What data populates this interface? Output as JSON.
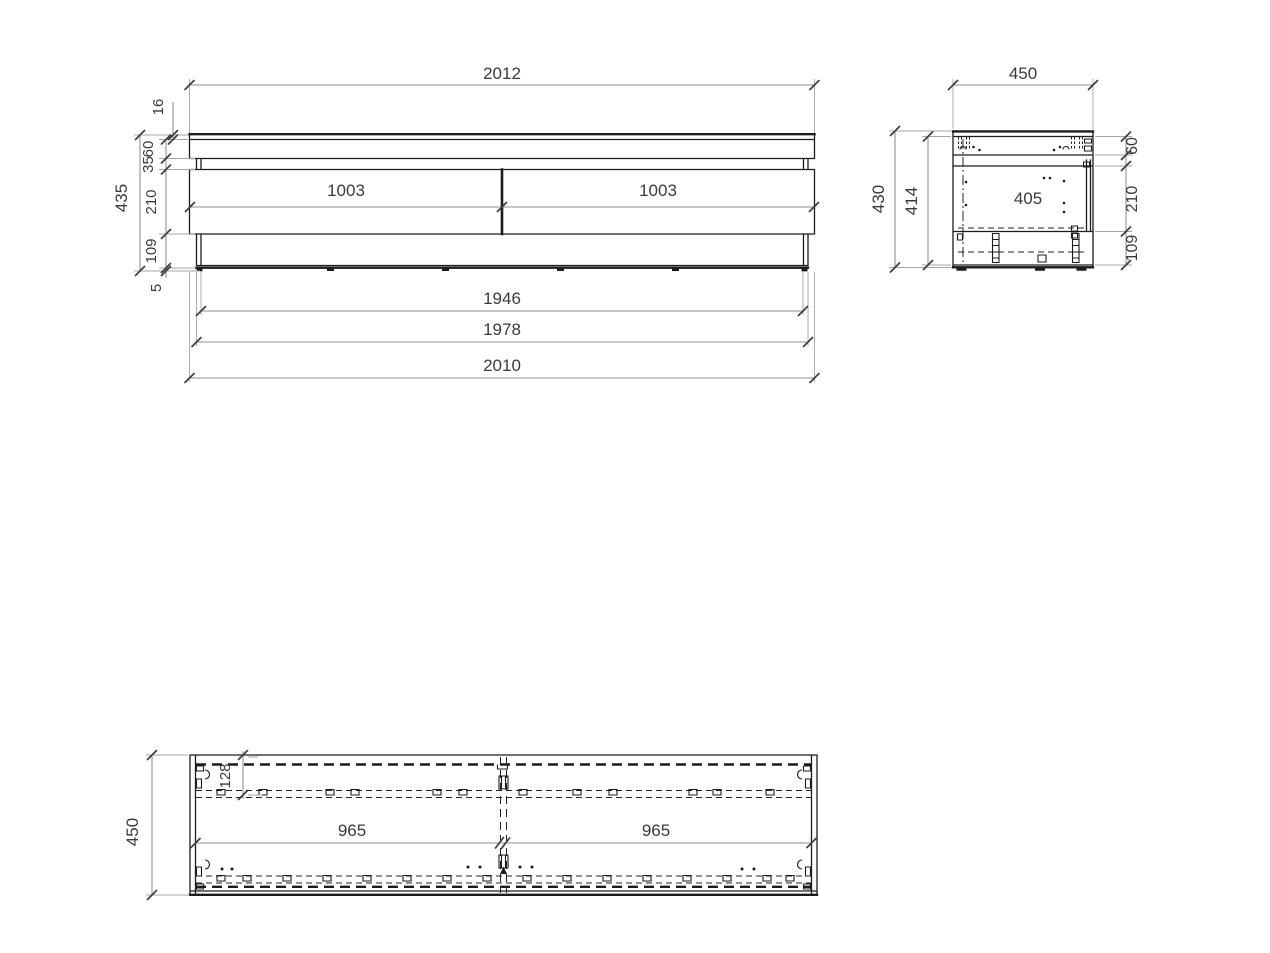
{
  "front_view": {
    "overall_width_top": "2012",
    "top_panel_thickness": "16",
    "upper_band_height": "60",
    "reveal_height": "35",
    "overall_height": "435",
    "drawer_height": "210",
    "base_height": "109",
    "foot_height": "5",
    "drawer_left_width": "1003",
    "drawer_right_width": "1003",
    "inner_width_bottom": "1946",
    "carcass_width_bottom": "1978",
    "overall_width_bottom": "2010"
  },
  "side_view": {
    "depth": "450",
    "overall_height": "430",
    "body_height": "414",
    "inner_depth": "405",
    "top_band_height": "60",
    "drawer_height": "210",
    "base_height": "109"
  },
  "plan_view": {
    "depth": "450",
    "back_offset": "128",
    "bay_left_width": "965",
    "bay_right_width": "965"
  },
  "colors": {
    "geometry_line": "#1c1c1c",
    "dimension_line": "#8f8f8f",
    "extension_line": "#a6a6a6",
    "tick": "#3d3d3d",
    "text": "#3a3a3a",
    "background": "#ffffff"
  }
}
